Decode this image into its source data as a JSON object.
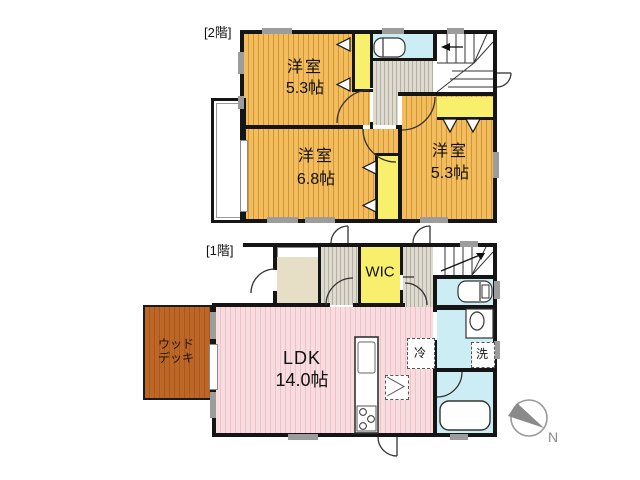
{
  "plan": {
    "type": "residential floor plan",
    "floors": {
      "second": {
        "label": "[2階]",
        "rooms": [
          {
            "id": "bedroom-a",
            "name": "洋室",
            "size": "5.3帖"
          },
          {
            "id": "bedroom-b",
            "name": "洋室",
            "size": "6.8帖"
          },
          {
            "id": "bedroom-c",
            "name": "洋室",
            "size": "5.3帖"
          }
        ]
      },
      "first": {
        "label": "[1階]",
        "wic": "WIC",
        "ldk": {
          "name": "LDK",
          "size": "14.0帖"
        },
        "deck": {
          "line1": "ウッド",
          "line2": "デッキ"
        },
        "fridge": "冷",
        "washer": "洗"
      }
    },
    "compass": {
      "north": "N"
    },
    "colors": {
      "wood_floor": "#f3bc5c",
      "wood_floor_stripe": "#cf9638",
      "hall_floor": "#dedacf",
      "hall_floor_stripe": "#b3afa1",
      "closet_yellow": "#f8ef6d",
      "wet_area_cyan": "#cdedf4",
      "ldk_pink": "#f8dcdf",
      "ldk_pink_stripe": "#eec3c8",
      "wood_deck_brown": "#bc6727",
      "wall": "#151515",
      "compass_gray": "#8a8a8a"
    }
  }
}
